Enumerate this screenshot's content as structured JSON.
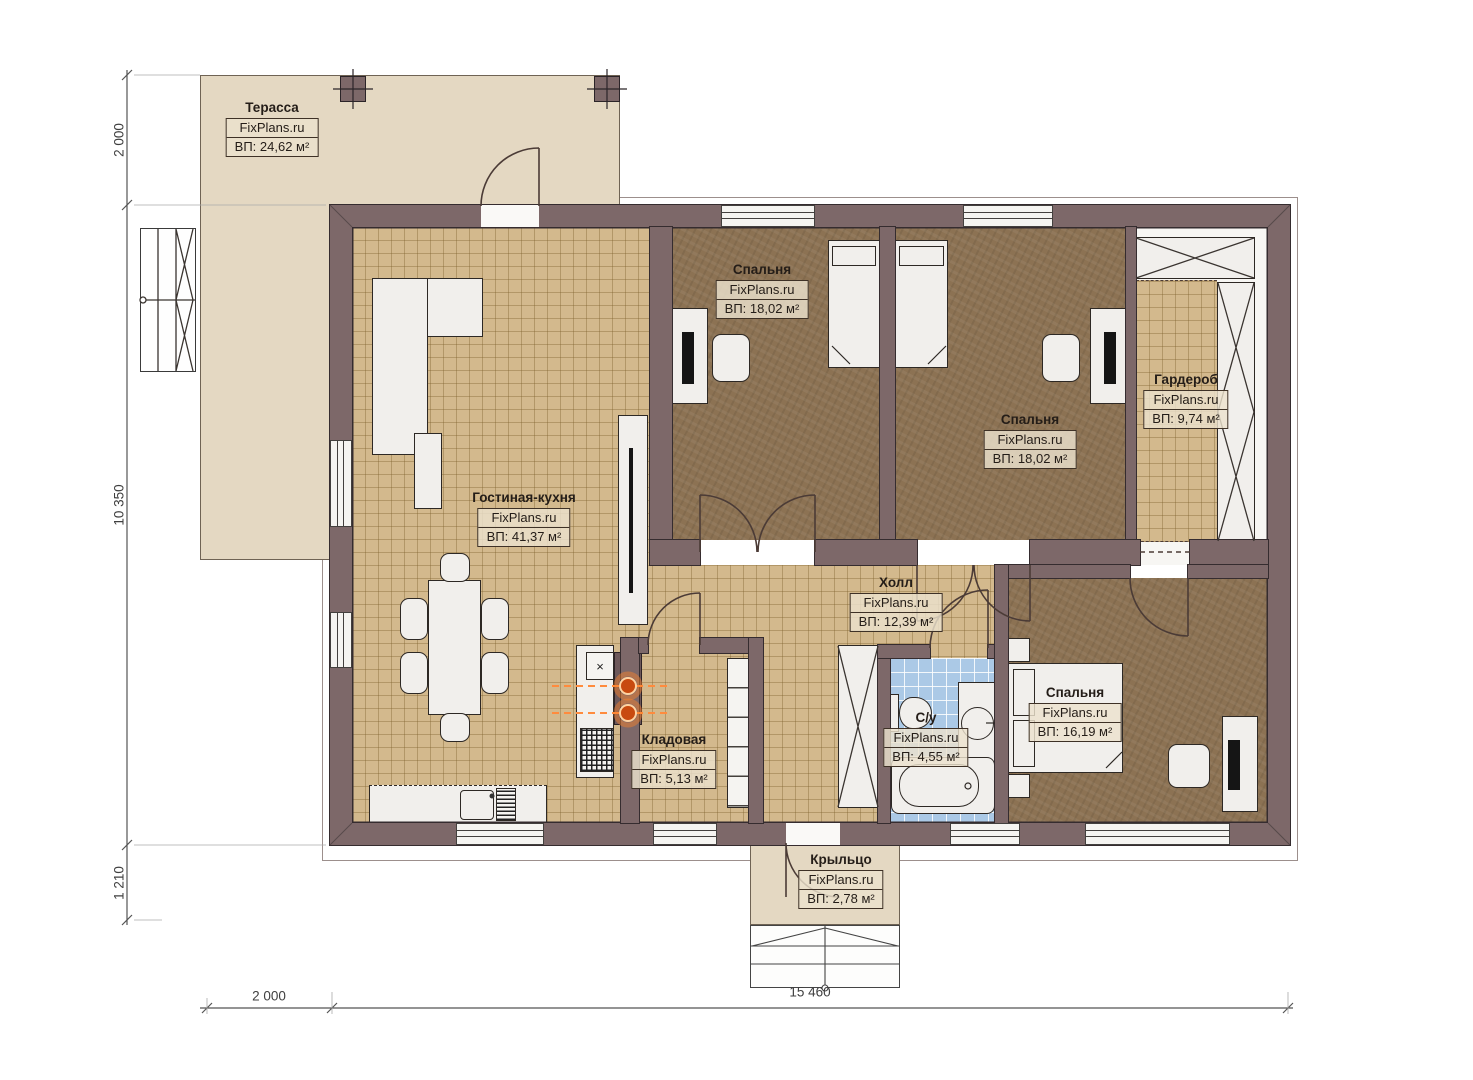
{
  "plan": {
    "brand": "FixPlans.ru",
    "rooms": [
      {
        "id": "terrace",
        "name": "Терасса",
        "area": "ВП: 24,62 м²"
      },
      {
        "id": "living",
        "name": "Гостиная-кухня",
        "area": "ВП: 41,37 м²"
      },
      {
        "id": "bedroom1",
        "name": "Спальня",
        "area": "ВП: 18,02 м²"
      },
      {
        "id": "bedroom2",
        "name": "Спальня",
        "area": "ВП: 18,02 м²"
      },
      {
        "id": "wardrobe",
        "name": "Гардероб",
        "area": "ВП: 9,74 м²"
      },
      {
        "id": "hall",
        "name": "Холл",
        "area": "ВП: 12,39 м²"
      },
      {
        "id": "storage",
        "name": "Кладовая",
        "area": "ВП: 5,13 м²"
      },
      {
        "id": "bathroom",
        "name": "С/у",
        "area": "ВП: 4,55 м²"
      },
      {
        "id": "bedroom3",
        "name": "Спальня",
        "area": "ВП: 16,19 м²"
      },
      {
        "id": "porch",
        "name": "Крыльцо",
        "area": "ВП: 2,78 м²"
      }
    ],
    "dimensions": {
      "left_top": "2 000",
      "left_middle": "10 350",
      "left_bottom": "1 210",
      "bottom_left": "2 000",
      "bottom_right": "15 460"
    },
    "symbols": {
      "hob_mark": "×"
    },
    "colors": {
      "wall": "#7d6869",
      "tile_floor": "#d3b98d",
      "bedroom_floor": "#8c7253",
      "bath_tile": "#abc9e6",
      "outdoor": "#e4d8c2",
      "burner_accent": "#ff8b3d"
    }
  }
}
